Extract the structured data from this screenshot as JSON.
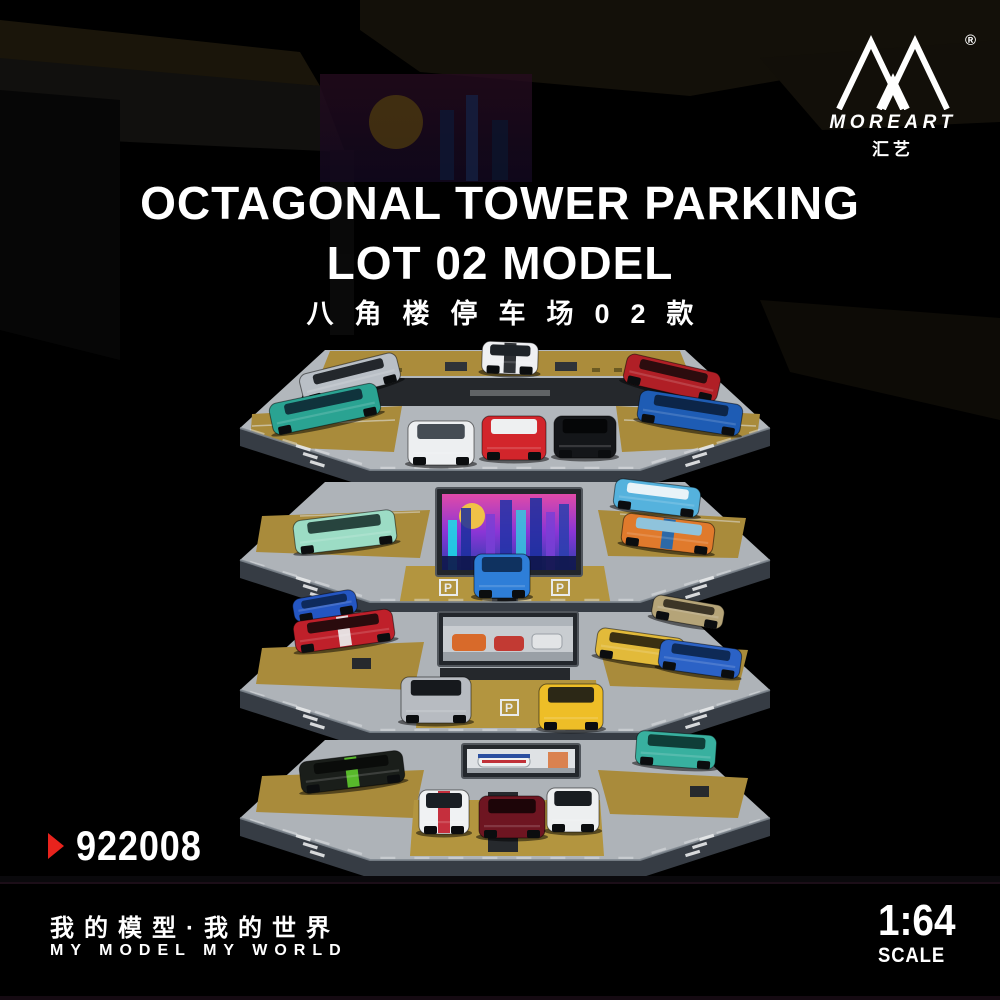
{
  "brand": {
    "logo_text": "MOREART",
    "logo_cn": "汇艺",
    "registered_mark": "®"
  },
  "title": {
    "line1": "OCTAGONAL TOWER PARKING",
    "line2": "LOT 02 MODEL",
    "subtitle_cn": "八角楼停车场02款"
  },
  "product": {
    "code": "922008"
  },
  "footer": {
    "slogan_cn": "我的模型·我的世界",
    "slogan_en": "MY MODEL MY WORLD",
    "scale_value": "1:64",
    "scale_label": "SCALE"
  },
  "colors": {
    "background": "#000000",
    "text": "#ffffff",
    "accent_red": "#e8231d",
    "deck_gray": "#b2b7bc",
    "deck_gold": "#b08f3c",
    "asphalt": "#25282c",
    "fascia": "#363c44",
    "pillar": "#5c646d",
    "billboard_neon_pink": "#d84aa6",
    "billboard_neon_blue": "#2b3fae"
  },
  "photo": {
    "alt": "Four-tier octagonal tower parking diorama filled with 1:64 scale model cars",
    "stall_mark": "P",
    "billboards": [
      "neon-city-screen",
      "garage-scene-screen",
      "race-car-screen"
    ],
    "tiers": [
      {
        "level": 1,
        "cars": [
          {
            "name": "silver-coupe",
            "x": 350,
            "y": 378,
            "w": 100,
            "h": 30,
            "rot": -14,
            "body": "#b9bfc6",
            "glass": "#23272c"
          },
          {
            "name": "teal-aventador",
            "x": 325,
            "y": 409,
            "w": 110,
            "h": 32,
            "rot": -12,
            "body": "#2aa392",
            "glass": "#10333c"
          },
          {
            "name": "white-918-stripes",
            "x": 510,
            "y": 358,
            "w": 56,
            "h": 32,
            "rot": 2,
            "body": "#eff0f2",
            "glass": "#1e2328",
            "stripe": "#23262a"
          },
          {
            "name": "white-hypercar",
            "x": 441,
            "y": 443,
            "w": 66,
            "h": 44,
            "rot": 0,
            "body": "#edeff1",
            "glass": "#454c54"
          },
          {
            "name": "red-white-racer",
            "x": 514,
            "y": 438,
            "w": 64,
            "h": 44,
            "rot": 0,
            "body": "#d2252b",
            "glass": "#eef0f1"
          },
          {
            "name": "black-hypercar",
            "x": 585,
            "y": 437,
            "w": 62,
            "h": 42,
            "rot": 0,
            "body": "#141619",
            "glass": "#050607"
          },
          {
            "name": "red-sports",
            "x": 672,
            "y": 378,
            "w": 96,
            "h": 30,
            "rot": 13,
            "body": "#b01f26",
            "glass": "#2c0c0e"
          },
          {
            "name": "blue-bugatti",
            "x": 690,
            "y": 413,
            "w": 104,
            "h": 32,
            "rot": 9,
            "body": "#1e5cb4",
            "glass": "#0c2548"
          }
        ]
      },
      {
        "level": 2,
        "cars": [
          {
            "name": "blue-van",
            "x": 657,
            "y": 498,
            "w": 86,
            "h": 30,
            "rot": 7,
            "body": "#55b2dd",
            "glass": "#e8f3f8"
          },
          {
            "name": "mint-rwb-porsche",
            "x": 345,
            "y": 532,
            "w": 102,
            "h": 34,
            "rot": -7,
            "body": "#9cdcc5",
            "glass": "#27443e"
          },
          {
            "name": "gulf-livery-car",
            "x": 668,
            "y": 534,
            "w": 92,
            "h": 32,
            "rot": 7,
            "body": "#e07a2c",
            "glass": "#8fc3dc",
            "stripe": "#2268ae"
          },
          {
            "name": "blue-gt3-wing",
            "x": 502,
            "y": 576,
            "w": 56,
            "h": 44,
            "rot": 0,
            "body": "#2e7ed8",
            "glass": "#0f3260"
          }
        ]
      },
      {
        "level": 3,
        "cars": [
          {
            "name": "blue-hatch",
            "x": 325,
            "y": 606,
            "w": 64,
            "h": 24,
            "rot": -10,
            "body": "#2456c2",
            "glass": "#0e2a5c"
          },
          {
            "name": "gold-coupe",
            "x": 688,
            "y": 612,
            "w": 72,
            "h": 24,
            "rot": 10,
            "body": "#b5a478",
            "glass": "#3c3526"
          },
          {
            "name": "red-race-livery",
            "x": 344,
            "y": 631,
            "w": 100,
            "h": 32,
            "rot": -8,
            "body": "#bf202a",
            "glass": "#2a0b0d",
            "stripe": "#e8e8e8"
          },
          {
            "name": "yellow-sedan",
            "x": 640,
            "y": 648,
            "w": 88,
            "h": 30,
            "rot": 8,
            "body": "#e2ba3a",
            "glass": "#3a3012"
          },
          {
            "name": "blue-skyline",
            "x": 700,
            "y": 659,
            "w": 82,
            "h": 30,
            "rot": 8,
            "body": "#2b62c6",
            "glass": "#0e2a56"
          },
          {
            "name": "silver-gtr",
            "x": 436,
            "y": 700,
            "w": 70,
            "h": 46,
            "rot": 0,
            "body": "#b7bbc1",
            "glass": "#16191d"
          },
          {
            "name": "yellow-rwb-porsche",
            "x": 571,
            "y": 707,
            "w": 64,
            "h": 46,
            "rot": 0,
            "body": "#eebe27",
            "glass": "#2c2816"
          }
        ]
      },
      {
        "level": 4,
        "cars": [
          {
            "name": "teal-jeep",
            "x": 676,
            "y": 750,
            "w": 80,
            "h": 34,
            "rot": 4,
            "body": "#38b09f",
            "glass": "#0f3e38"
          },
          {
            "name": "kenblock-livery",
            "x": 352,
            "y": 772,
            "w": 104,
            "h": 32,
            "rot": -7,
            "body": "#1a1e1a",
            "glass": "#0a0c0a",
            "stripe": "#5cc22c"
          },
          {
            "name": "martini-porsche",
            "x": 444,
            "y": 812,
            "w": 50,
            "h": 44,
            "rot": 0,
            "body": "#f0f2f3",
            "glass": "#1a1f24",
            "stripe": "#c22433"
          },
          {
            "name": "dark-red-918",
            "x": 512,
            "y": 817,
            "w": 66,
            "h": 42,
            "rot": 0,
            "body": "#6e1521",
            "glass": "#1d0508"
          },
          {
            "name": "white-rwb-993",
            "x": 573,
            "y": 810,
            "w": 52,
            "h": 44,
            "rot": 0,
            "body": "#edeff0",
            "glass": "#181c20"
          }
        ]
      }
    ]
  }
}
